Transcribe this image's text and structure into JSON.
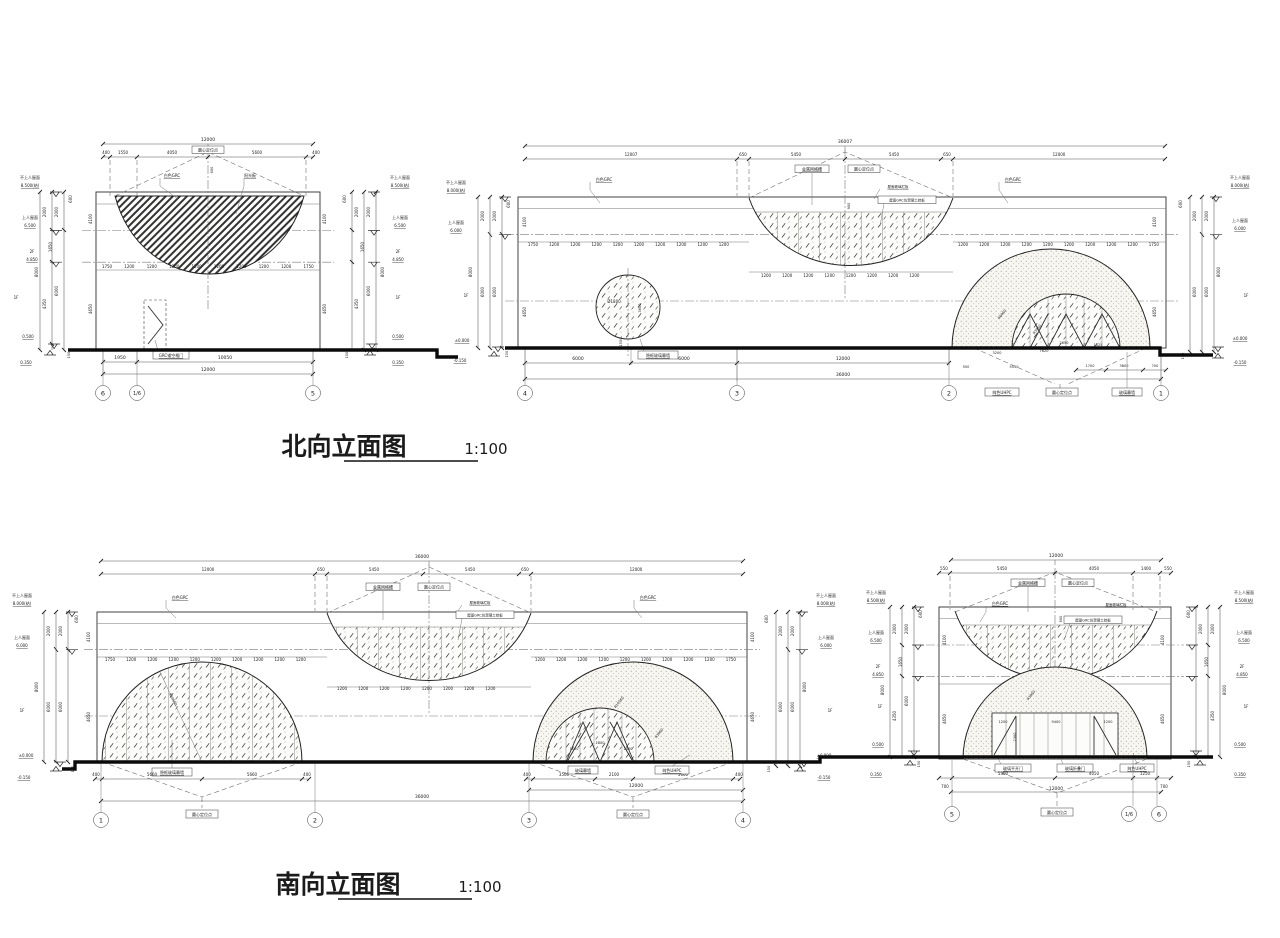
{
  "titles": {
    "north": "北向立面图",
    "south": "南向立面图",
    "scale": "1:100"
  },
  "materials": {
    "grc_white": "白色GRC",
    "center_point": "圆心定位点",
    "mesh_grille": "金属网格栅",
    "roof_rail": "屋面玻璃栏板",
    "grc_panel": "屋面GRC仿混凝土挂板",
    "hidden_glass": "隐框玻璃幕墙",
    "glass_wall": "玻璃幕墙",
    "uhpc": "纯色UHPC",
    "grc_door": "GRC镂空格门",
    "swing_door": "玻璃平开门",
    "folding_door": "玻璃折叠门",
    "sun_board": "阳光板",
    "circle_dia": "Ø1800"
  },
  "levels": {
    "small": {
      "roof_na": "不上人屋面",
      "roof_na_v": "8.500(结)",
      "roof_ac": "上人屋面",
      "roof_ac_v": "6.500",
      "f2": "2F",
      "f2_v": "4.850",
      "f1": "1F",
      "ground_v": "0.500",
      "site_v": "0.350",
      "dims": [
        "600",
        "2000",
        "2000",
        "1650",
        "8000",
        "6000",
        "4350",
        "4650",
        "4100",
        "150"
      ]
    },
    "main": {
      "roof_na": "不上人屋面",
      "roof_na_v": "8.000(结)",
      "roof_ac": "上人屋面",
      "roof_ac_v": "6.000",
      "f1": "1F",
      "zero_v": "±0.000",
      "minus_v": "-0.150",
      "dims": [
        "600",
        "2000",
        "2000",
        "8000",
        "6000",
        "6000",
        "4100",
        "4650",
        "150"
      ]
    }
  },
  "n_small": {
    "total_top": "12000",
    "top_chain": [
      "400",
      "1550",
      "4050",
      "5600",
      "400"
    ],
    "band": [
      "1750",
      "1200",
      "1200",
      "1200",
      "1200",
      "1200",
      "1200",
      "1200",
      "1200",
      "1750"
    ],
    "bowl_dim": "600",
    "bottom_chain": [
      "1950",
      "10050"
    ],
    "total_bottom": "12000",
    "grids": [
      "6",
      "1/6",
      "5"
    ]
  },
  "n_main": {
    "total_top": "36007",
    "top_chain": [
      "12007",
      "650",
      "5450",
      "5450",
      "650",
      "12000"
    ],
    "band_left": [
      "1750",
      "1200",
      "1200",
      "1200",
      "1200",
      "1200",
      "1200",
      "1200",
      "1200",
      "1200"
    ],
    "band_mid": [
      "1200",
      "1200",
      "1200",
      "1200",
      "1200",
      "1200",
      "1200",
      "1200"
    ],
    "band_right": [
      "1200",
      "1200",
      "1200",
      "1200",
      "1200",
      "1200",
      "1200",
      "1200",
      "1200",
      "1750"
    ],
    "band_h": "900",
    "circle_h": "3600",
    "circle_b": "1500",
    "r_outer": "R6960",
    "r_inner": "R3960",
    "dome_dims": [
      "3200",
      "7620",
      "2650",
      "1025"
    ],
    "dome_chain": [
      "500",
      "5550",
      "1700",
      "3800",
      "700"
    ],
    "bottom_chain": [
      "6000",
      "6000",
      "12000"
    ],
    "total_bottom": "36000",
    "grids": [
      "4",
      "3",
      "2",
      "1"
    ]
  },
  "s_main": {
    "total_top": "36000",
    "top_chain": [
      "12000",
      "650",
      "5450",
      "5450",
      "650",
      "12000"
    ],
    "band_left": [
      "1750",
      "1200",
      "1200",
      "1200",
      "1200",
      "1200",
      "1200",
      "1200",
      "1200",
      "1200"
    ],
    "band_mid": [
      "1200",
      "1200",
      "1200",
      "1200",
      "1200",
      "1200",
      "1200",
      "1200"
    ],
    "band_right": [
      "1200",
      "1200",
      "1200",
      "1200",
      "1200",
      "1200",
      "1200",
      "1200",
      "1200",
      "1750"
    ],
    "r_left": "R10560",
    "r_outer": "R10560",
    "r_inner": "R3960",
    "left_chain": [
      "400",
      "5660",
      "5660",
      "400"
    ],
    "right_chain": [
      "400",
      "3500",
      "2100",
      "5660",
      "400"
    ],
    "door_dims": [
      "1100",
      "1800",
      "1400"
    ],
    "right_12000": "12000",
    "total_bottom": "36000",
    "grids": [
      "1",
      "2",
      "3",
      "4"
    ]
  },
  "s_small": {
    "total_top": "12000",
    "top_chain": [
      "550",
      "5450",
      "4050",
      "1400",
      "550"
    ],
    "band_h": "600",
    "door_dims": [
      "1200",
      "2300",
      "9400",
      "1200"
    ],
    "r_inner": "R3960",
    "bottom_chain": [
      "700",
      "5300",
      "4050",
      "1250",
      "700"
    ],
    "total_bottom": "12000",
    "grids": [
      "5",
      "1/6",
      "6"
    ]
  }
}
